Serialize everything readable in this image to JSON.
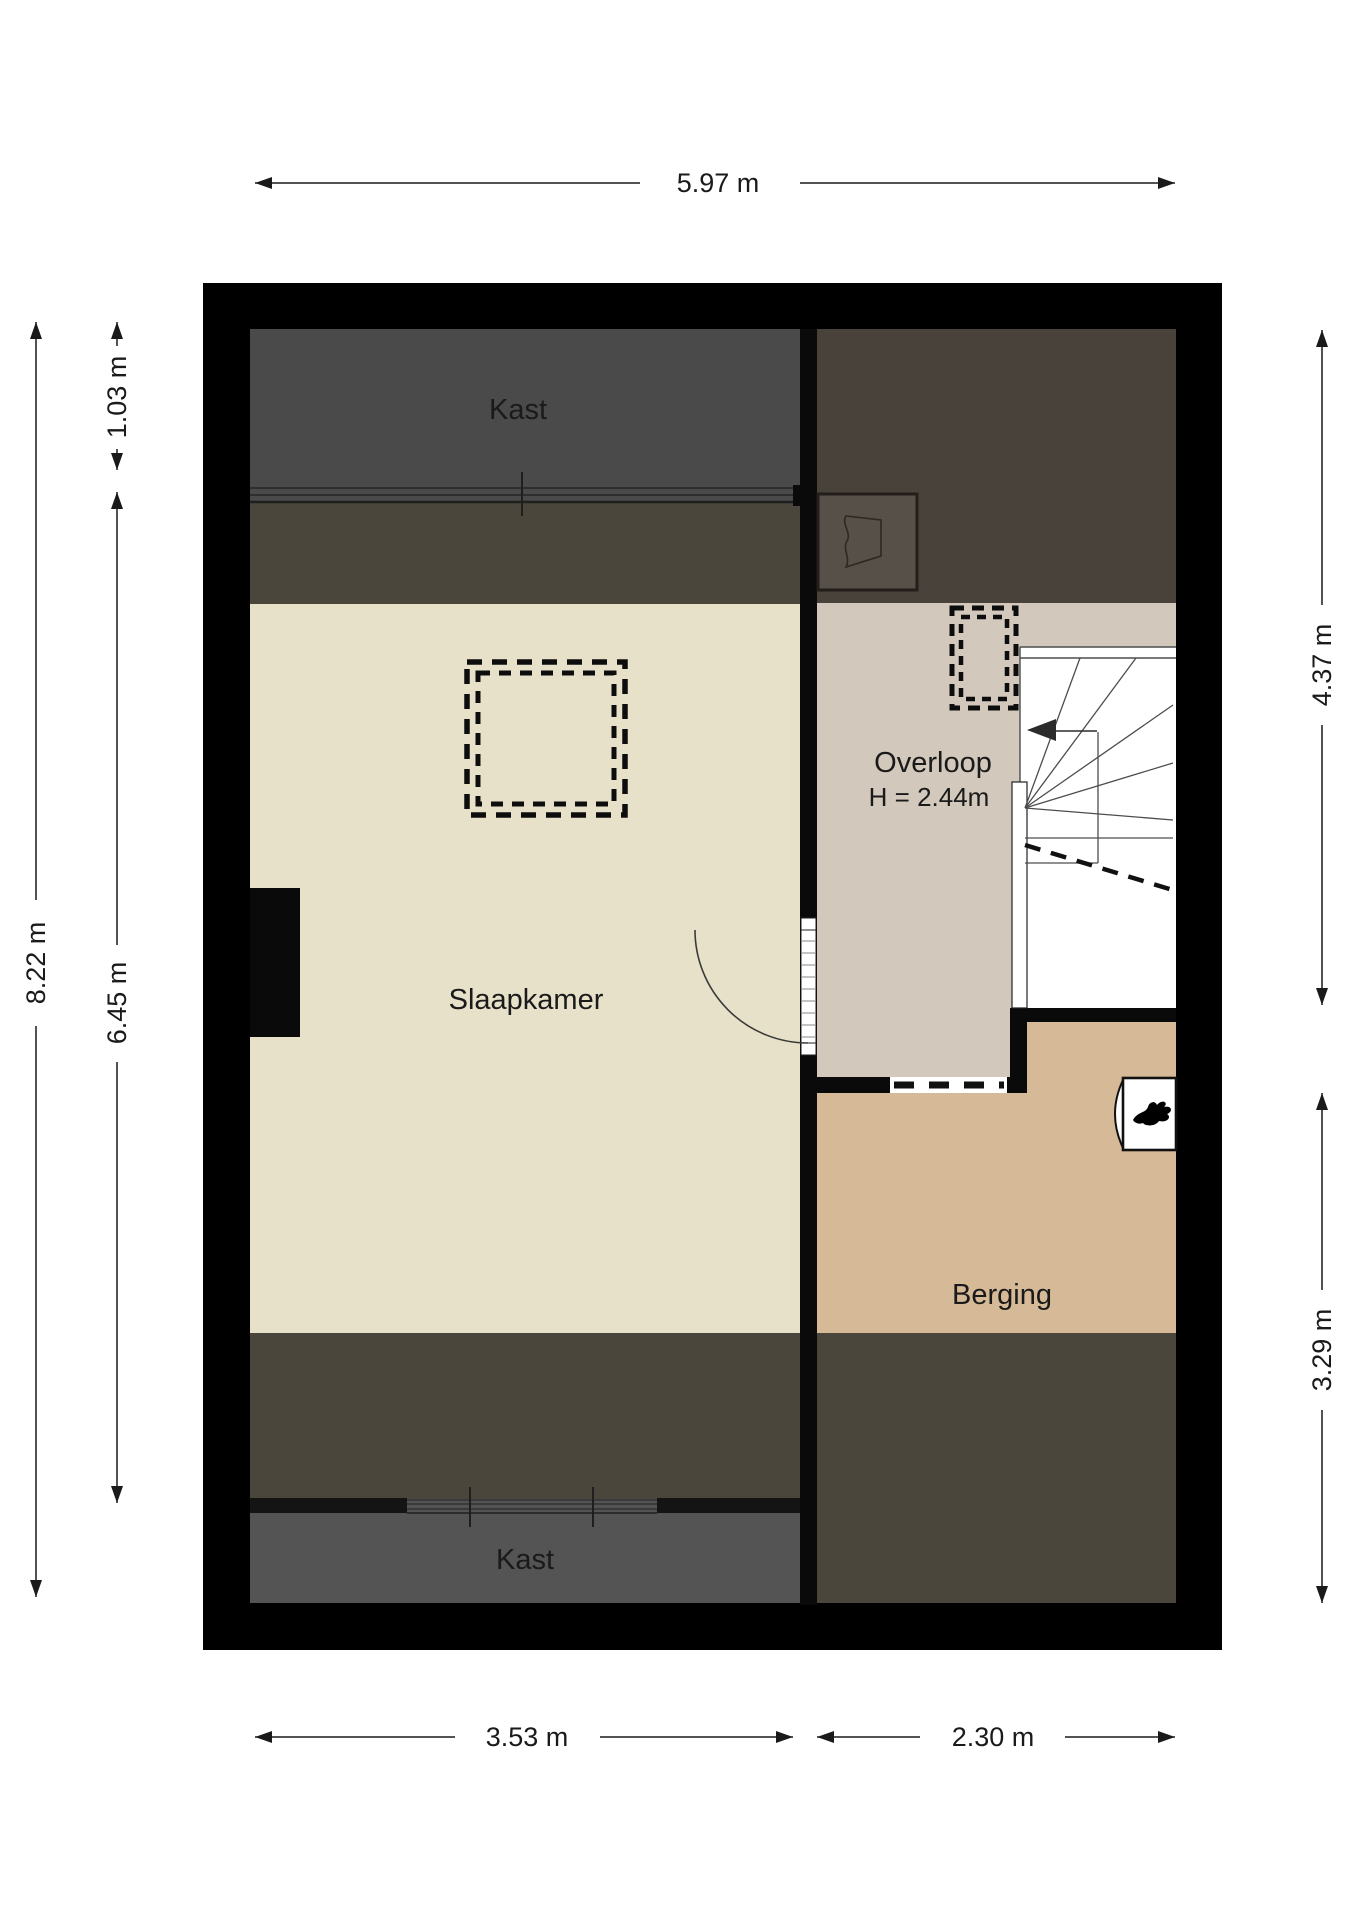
{
  "plan": {
    "rooms": {
      "kast_top": "Kast",
      "slaapkamer": "Slaapkamer",
      "overloop": "Overloop",
      "overloop_ceiling_height": "H = 2.44m",
      "berging": "Berging",
      "kast_bottom": "Kast"
    },
    "dimensions": {
      "total_width": "5.97 m",
      "total_height": "8.22 m",
      "kast_top_depth": "1.03 m",
      "slaapkamer_length": "6.45 m",
      "right_upper_height": "4.37 m",
      "right_lower_height": "3.29 m",
      "bottom_left_width": "3.53 m",
      "bottom_right_width": "2.30 m"
    },
    "colors": {
      "wall": "#000000",
      "kast_top_floor": "#4a4a4a",
      "sloped_zone": "#4a463c",
      "slaapkamer_floor": "#e7e1ca",
      "kast_bottom_floor": "#545454",
      "dark_attic": "#48423a",
      "overloop_floor": "#d2c8bb",
      "berging_floor": "#d6ba97",
      "dormer": "#575049",
      "stairs": "#ffffff"
    }
  }
}
